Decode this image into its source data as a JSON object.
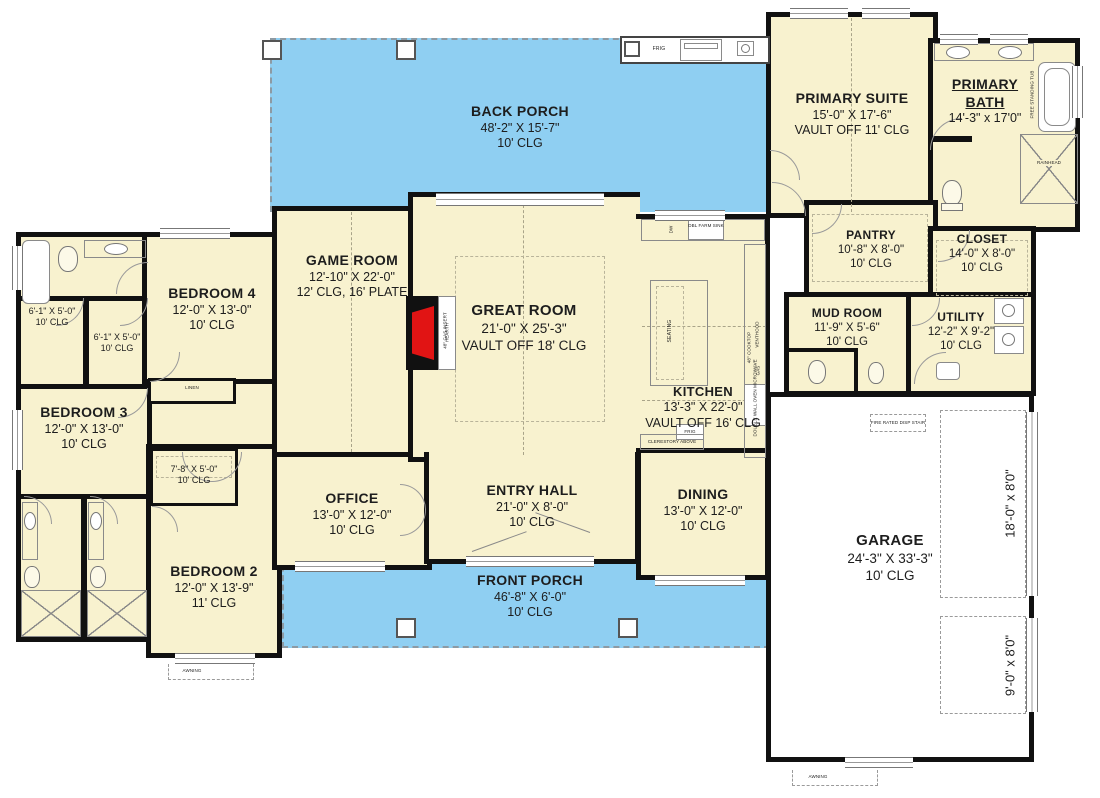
{
  "colors": {
    "porch_blue": "#8fcff2",
    "room_cream": "#f8f2cf",
    "wall_black": "#111111",
    "fire_red": "#e11414",
    "text": "#1d1d1d"
  },
  "rooms": {
    "back_porch": {
      "name": "BACK PORCH",
      "dim": "48'-2\" X 15'-7\"",
      "clg": "10' CLG"
    },
    "front_porch": {
      "name": "FRONT PORCH",
      "dim": "46'-8\" X 6'-0\"",
      "clg": "10' CLG"
    },
    "great_room": {
      "name": "GREAT ROOM",
      "dim": "21'-0\" X 25'-3\"",
      "clg": "VAULT OFF 18' CLG"
    },
    "game_room": {
      "name": "GAME ROOM",
      "dim": "12'-10\" X 22'-0\"",
      "clg": "12' CLG, 16' PLATE"
    },
    "kitchen": {
      "name": "KITCHEN",
      "dim": "13'-3\" X 22'-0\"",
      "clg": "VAULT OFF 16' CLG"
    },
    "office": {
      "name": "OFFICE",
      "dim": "13'-0\" X 12'-0\"",
      "clg": "10' CLG"
    },
    "entry_hall": {
      "name": "ENTRY HALL",
      "dim": "21'-0\" X 8'-0\"",
      "clg": "10' CLG"
    },
    "dining": {
      "name": "DINING",
      "dim": "13'-0\" X 12'-0\"",
      "clg": "10' CLG"
    },
    "garage": {
      "name": "GARAGE",
      "dim": "24'-3\" X 33'-3\"",
      "clg": "10' CLG"
    },
    "primary_suite": {
      "name": "PRIMARY SUITE",
      "dim": "15'-0\" X 17'-6\"",
      "clg": "VAULT OFF 11' CLG"
    },
    "primary_bath": {
      "name1": "PRIMARY",
      "name2": "BATH",
      "dim": "14'-3\" x 17'0\""
    },
    "pantry": {
      "name": "PANTRY",
      "dim": "10'-8\" X 8'-0\"",
      "clg": "10' CLG"
    },
    "closet": {
      "name": "CLOSET",
      "dim": "14'-0\" X 8'-0\"",
      "clg": "10' CLG"
    },
    "mud_room": {
      "name": "MUD ROOM",
      "dim": "11'-9\" X 5'-6\"",
      "clg": "10' CLG"
    },
    "utility": {
      "name": "UTILITY",
      "dim": "12'-2\" X 9'-2\"",
      "clg": "10' CLG"
    },
    "bedroom_4": {
      "name": "BEDROOM 4",
      "dim": "12'-0\" X 13'-0\"",
      "clg": "10' CLG"
    },
    "bedroom_3": {
      "name": "BEDROOM 3",
      "dim": "12'-0\" X 13'-0\"",
      "clg": "10' CLG"
    },
    "bedroom_2": {
      "name": "BEDROOM 2",
      "dim": "12'-0\" X 13'-9\"",
      "clg": "11' CLG"
    },
    "closet_a": {
      "dim": "6'-1\" X 5'-0\"",
      "clg": "10' CLG"
    },
    "closet_b": {
      "dim": "6'-1\" X 5'-0\"",
      "clg": "10' CLG"
    },
    "closet_c": {
      "dim": "7'-8\" X 5'-0\"",
      "clg": "10' CLG"
    }
  },
  "fixtures": {
    "frig": "FRIG",
    "linen": "LINEN",
    "awning": "AWNING",
    "fire_rated_stair": "FIRE RATED DISP STAIR",
    "garage_door_large": "18'-0\" x 8'0\"",
    "garage_door_small": "9'-0\" x 8'0\"",
    "seating": "SEATING",
    "dbl_farm_sink": "DBL FARM SINK",
    "dw": "DW",
    "cooktop": "48\" COOKTOP",
    "venthood": "VENTHOOD",
    "gas": "GAS",
    "double_wall_oven": "DOUBLE WALL OVEN MICROWAVE",
    "clerestory": "CLERESTORY ABOVE",
    "gas_insert": "48\" GAS INSERT",
    "hearth": "HEARTH",
    "free_standing_tub": "FREE STANDING TUB",
    "rainhead": "RAINHEAD"
  }
}
